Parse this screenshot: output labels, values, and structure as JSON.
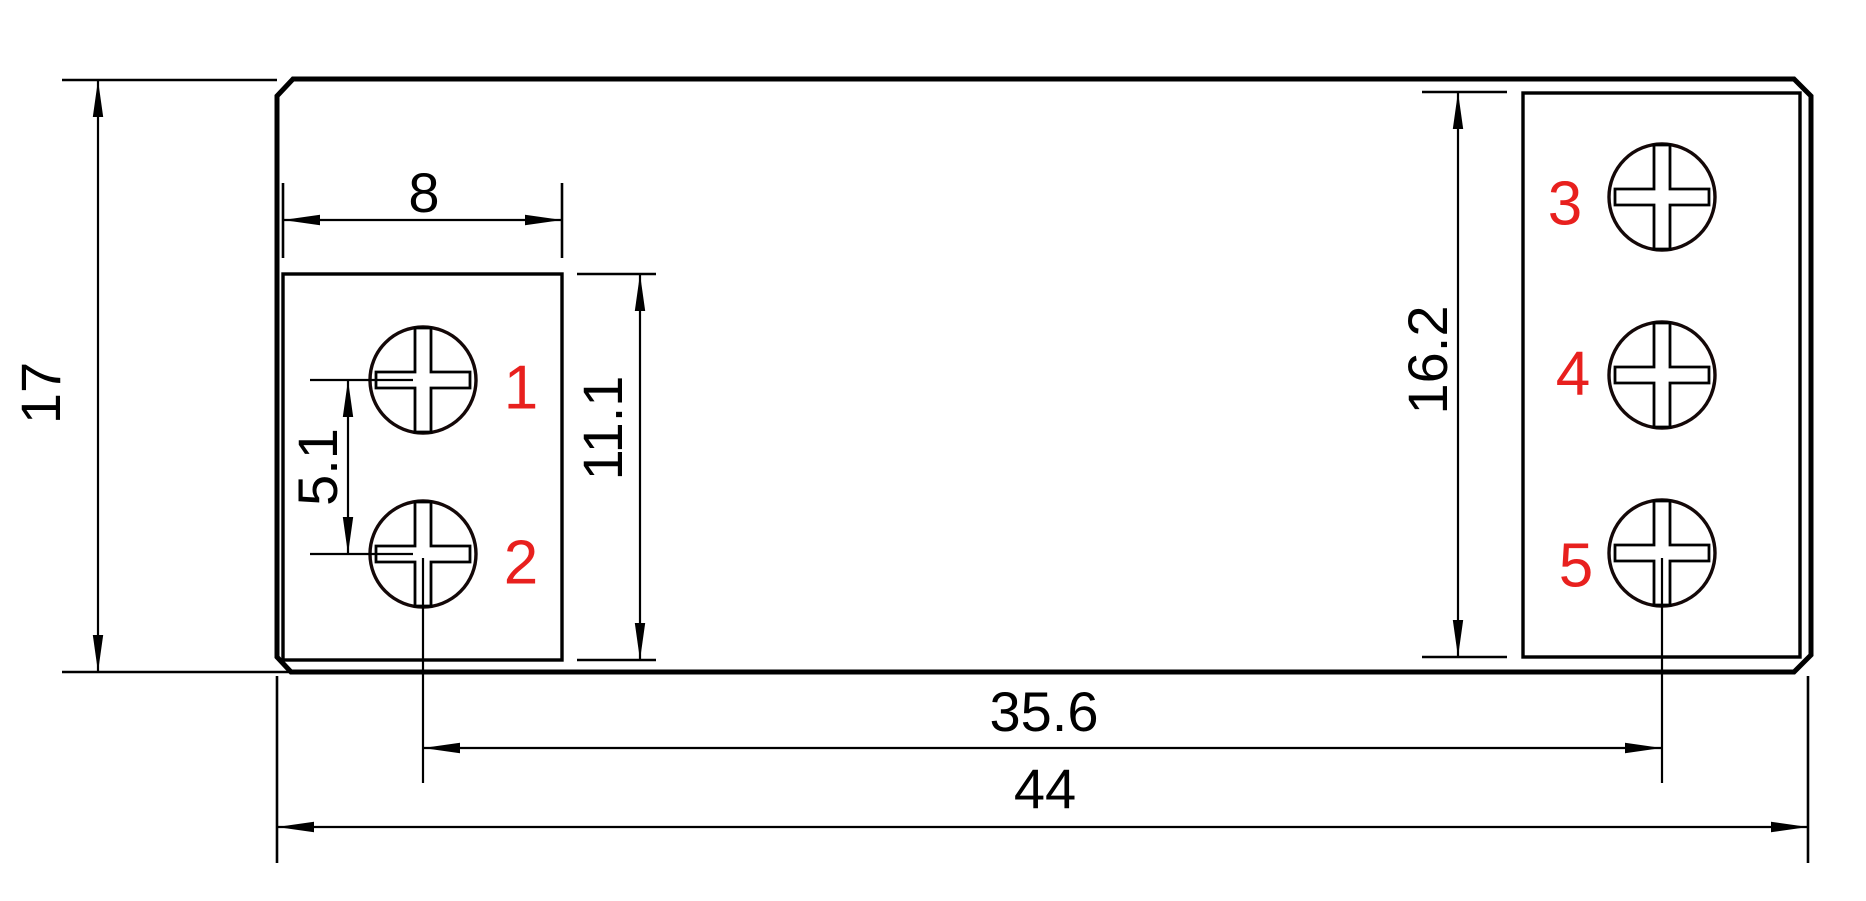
{
  "dimensions": {
    "total_height": {
      "value": "17"
    },
    "left_block_width": {
      "value": "8"
    },
    "left_screw_pitch": {
      "value": "5.1"
    },
    "left_block_height": {
      "value": "11.1"
    },
    "right_block_height": {
      "value": "16.2"
    },
    "screw_center_span": {
      "value": "35.6"
    },
    "total_width": {
      "value": "44"
    }
  },
  "terminals": [
    {
      "number": "1"
    },
    {
      "number": "2"
    },
    {
      "number": "3"
    },
    {
      "number": "4"
    },
    {
      "number": "5"
    }
  ],
  "colors": {
    "line_color": "#000000",
    "terminal_label_color": "#e8201e",
    "background": "#ffffff"
  }
}
